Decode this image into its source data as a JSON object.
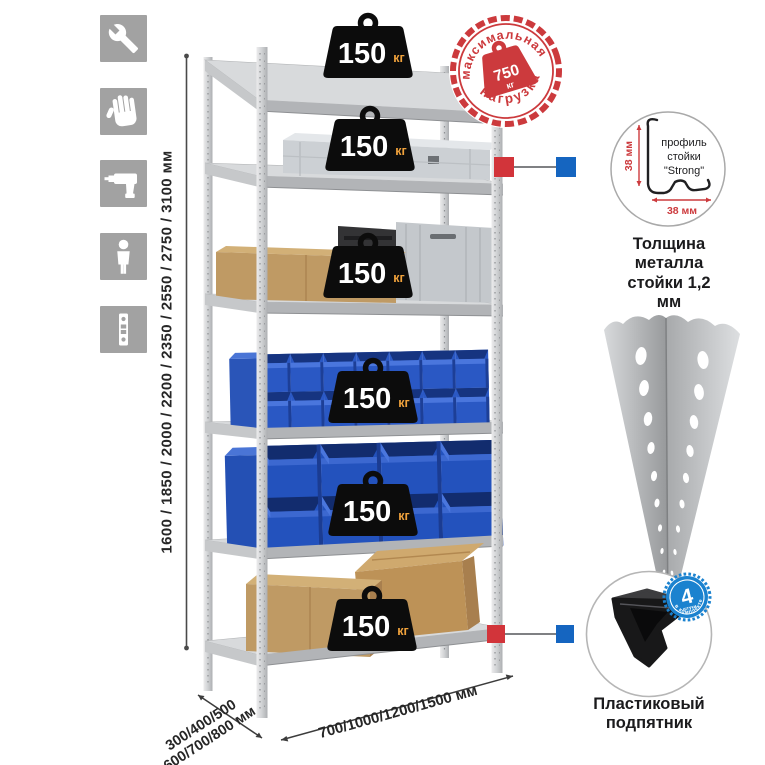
{
  "feature_icons": [
    {
      "icon": "wrench-icon"
    },
    {
      "icon": "gloves-icon"
    },
    {
      "icon": "drill-icon"
    },
    {
      "icon": "person-icon"
    },
    {
      "icon": "level-icon"
    }
  ],
  "dimensions": {
    "height": "1600 / 1850 / 2000 / 2200 / 2350 / 2550 / 2750 / 3100 мм",
    "depth_line1": "300/400/500",
    "depth_line2": "600/700/800 мм",
    "width": "700/1000/1200/1500 мм"
  },
  "rack": {
    "badges": [
      {
        "value": "150",
        "unit": "кг"
      },
      {
        "value": "150",
        "unit": "кг"
      },
      {
        "value": "150",
        "unit": "кг"
      },
      {
        "value": "150",
        "unit": "кг"
      },
      {
        "value": "150",
        "unit": "кг"
      },
      {
        "value": "150",
        "unit": "кг"
      }
    ]
  },
  "max_load_stamp": {
    "top_text": "максимальная",
    "bottom_text": "нагрузка",
    "value": "750",
    "unit": "кг"
  },
  "profile_detail": {
    "label_line1": "профиль",
    "label_line2": "стойки",
    "label_line3": "\"Strong\"",
    "dim_vertical": "38 мм",
    "dim_horizontal": "38 мм",
    "caption_line1": "Толщина металла",
    "caption_line2": "стойки 1,2 мм"
  },
  "foot_detail": {
    "badge_value": "4",
    "badge_small": "штуки",
    "badge_curved": "в комплекте",
    "caption_line1": "Пластиковый",
    "caption_line2": "подпятник"
  },
  "palette": {
    "stamp_red": "#cc3a3d",
    "connector_red": "#d2343a",
    "connector_blue": "#1565c0",
    "bin_blue": "#2a58c4",
    "cardboard": "#bf9a64",
    "metal_gray": "#c9cbcd",
    "weight_black": "#0c0c0c",
    "unit_orange": "#f0a23c",
    "icon_gray": "#a2a2a2"
  }
}
